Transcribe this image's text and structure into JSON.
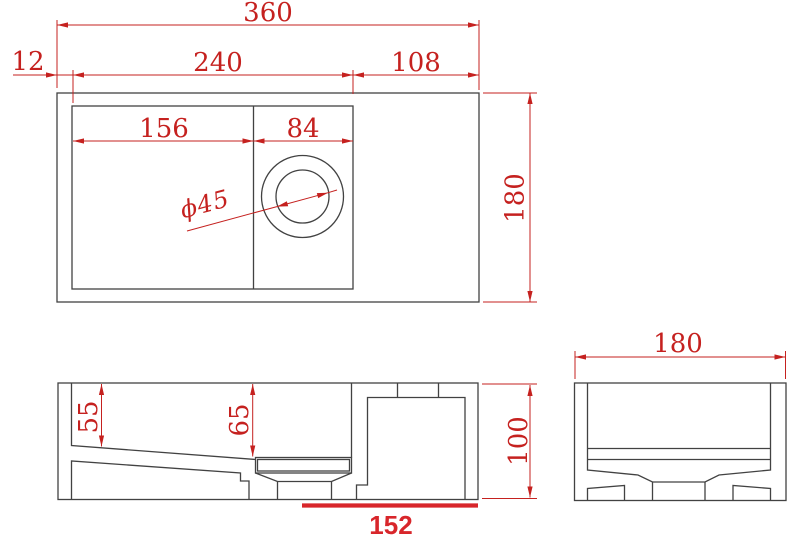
{
  "colors": {
    "line": "#424242",
    "dimension": "#c5211f",
    "highlight": "#d8262b"
  },
  "plan": {
    "overall_width": "360",
    "left_wall": "12",
    "basin_span": "240",
    "right_deck": "108",
    "basin_left": "156",
    "basin_right": "84",
    "depth": "180",
    "hole_diameter": "ϕ45"
  },
  "front": {
    "left_depth": "55",
    "mid_depth": "65",
    "height": "100",
    "bottom_span": "152"
  },
  "side": {
    "width": "180"
  }
}
